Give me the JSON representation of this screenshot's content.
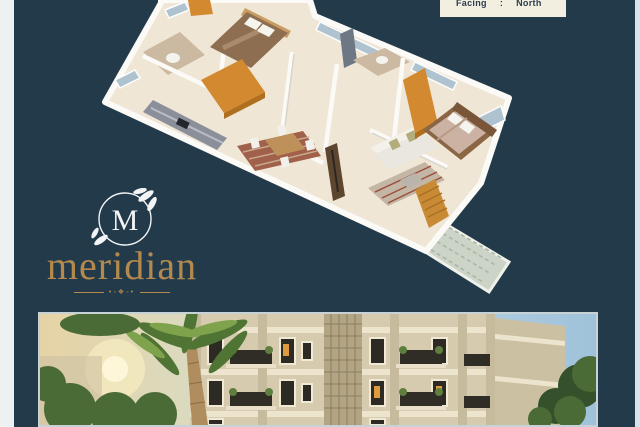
{
  "canvas": {
    "bg": "#233a4a",
    "left_bar": "#eef1f2",
    "right_bar": "#d7e3e7"
  },
  "facing_box": {
    "bg": "#f3efe0",
    "text_color": "#2c3c4e",
    "label": "Facing",
    "separator": ":",
    "value": "North"
  },
  "logo": {
    "monogram": "M",
    "wordmark": "meridian",
    "gold": "#b3894d",
    "emblem_color": "#f2f4f5",
    "ornament_glyphs": "•◦❖◦•"
  },
  "floor_plan": {
    "type": "3d-isometric-floor-plan",
    "rooms": [
      "bedroom-1",
      "bathroom-1",
      "kitchen",
      "dining",
      "living",
      "bedroom-2",
      "bathroom-2",
      "balcony",
      "stairs"
    ],
    "colors": {
      "floor": "#efe6d6",
      "wall": "#fbfaf7",
      "wall_shadow": "#d8d4cb",
      "wardrobe": "#d2892f",
      "wardrobe_dark": "#b06f1f",
      "bed1_blanket": "#8d6e50",
      "headboard": "#c89c62",
      "bed2_frame": "#8a6645",
      "bed2_mattress": "#cbb2a2",
      "bed2_headboard": "#7a5638",
      "pillow": "#f6f4ef",
      "wood": "#bd9159",
      "rug_dining": "#a0604a",
      "rug_dining_stripe": "#c8a88e",
      "rug_living": "#c4b6a4",
      "rug_living_stripe": "#9c4f3f",
      "sofa": "#e9e7df",
      "sofa_back": "#f3f1ea",
      "cushion": "#b3ad7c",
      "counter": "#8b8f99",
      "glass": "#aec2d0",
      "tile": "#cbb9a2",
      "door": "#6e7884",
      "tv_unit": "#5c462f",
      "balcony": "#ccd4c7",
      "balcony_line": "#a9b4a5",
      "stairs": "#c98a35"
    }
  },
  "photo": {
    "subject": "apartment-building-exterior-render",
    "border": "#c6d2d5",
    "colors": {
      "sky_left": "#e5d3a4",
      "sky_right": "#9fc2da",
      "facade": "#d6cbae",
      "facade_side": "#cbc0a2",
      "band": "#ece4cc",
      "pilaster": "#c6bb9c",
      "lattice": "#b3a584",
      "window": "#2c2a22",
      "window_frame": "#efe9d6",
      "window_glow": "#e09a3e",
      "railing": "#2f2d26",
      "plant": "#5e7f3e",
      "trunk": "#b08d5e",
      "palm_dark": "#4f7434",
      "palm_light": "#7fa24c",
      "foliage": "#4a6a36",
      "foliage_dark": "#35512c",
      "glow": "#f7ecc0"
    }
  }
}
